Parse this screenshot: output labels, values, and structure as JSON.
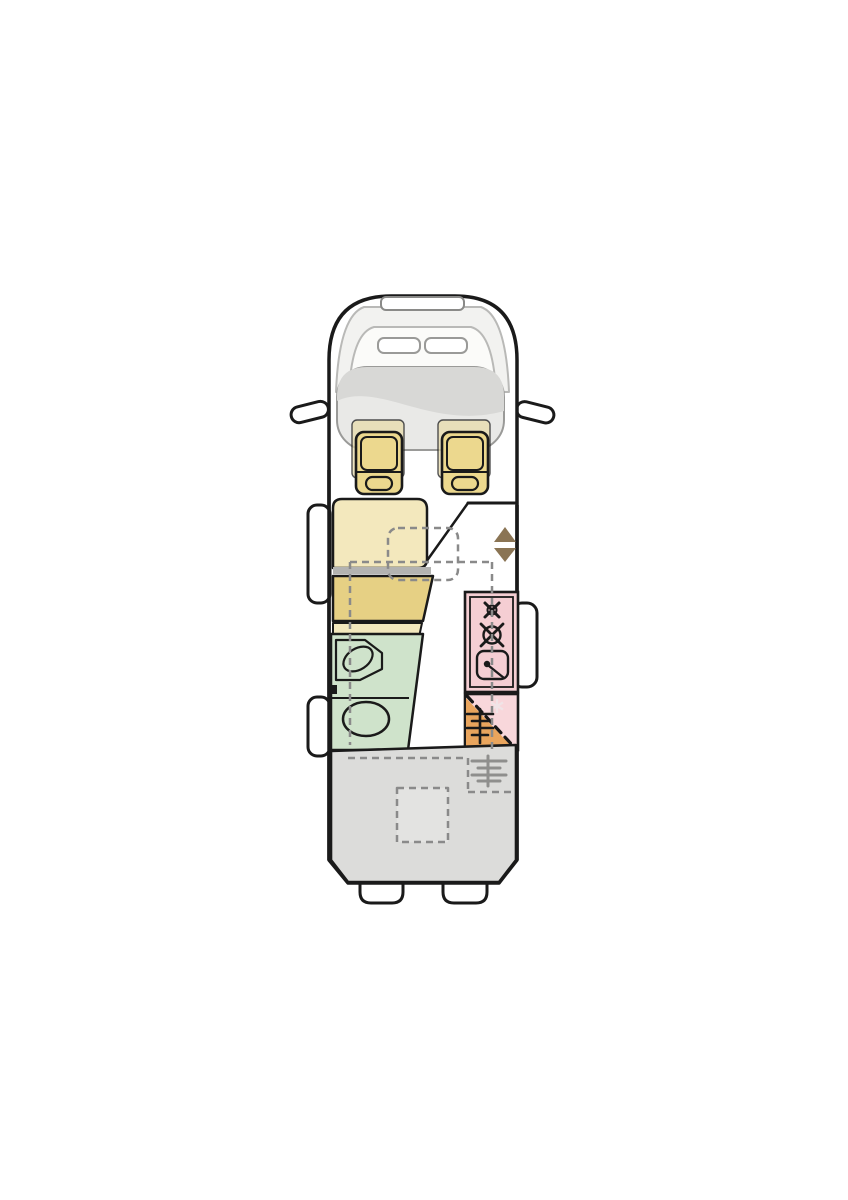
{
  "diagram": {
    "type": "motorhome-floorplan-top-view",
    "colors": {
      "background": "#ffffff",
      "body_fill": "#ffffff",
      "outline": "#1a1a1a",
      "glass_shade": "#f2f2f0",
      "glass_inner": "#fbfbf9",
      "dashboard": "#e9e9e7",
      "dashboard_dark": "#d8d8d6",
      "seat": "#ecd88e",
      "seat_pad": "#e8dcab",
      "bench_light": "#f3e8bd",
      "bench_dark": "#e6d084",
      "divider": "#b3b3b1",
      "bathroom": "#cfe3cb",
      "kitchen": "#f5ced3",
      "fridge_pink": "#f8d7db",
      "wardrobe_orange": "#e9a55d",
      "bed_gray": "#dcdcda",
      "skylight_gray": "#e3e3e1",
      "arrow_brown": "#8a7454",
      "heater_gray": "#8f8f8d",
      "snowflake_pale": "#f0e4e7"
    },
    "elements": {
      "cab": "driver cab with windshield, dashboard and two swivel seats",
      "mirrors": "left and right exterior mirrors",
      "entry_arrows": "entrance direction arrows (up / down)",
      "dinette": "face-to-face bench seating with dashed table outline",
      "drop_bed_outline": "dashed outline of drop-down bed over lounge",
      "bathroom": "washroom with corner basin and toilet",
      "kitchen": "kitchen block with two-burner hob and sink",
      "fridge_wardrobe": "fridge / wardrobe unit with heater symbol and snowflake",
      "entry_door": "entry door on right wall",
      "windows": "two side windows on left wall",
      "rear_bed": "rear transverse bed area with skylight outline and heater symbol",
      "rear_bumpers": "rear bumper steps"
    }
  }
}
